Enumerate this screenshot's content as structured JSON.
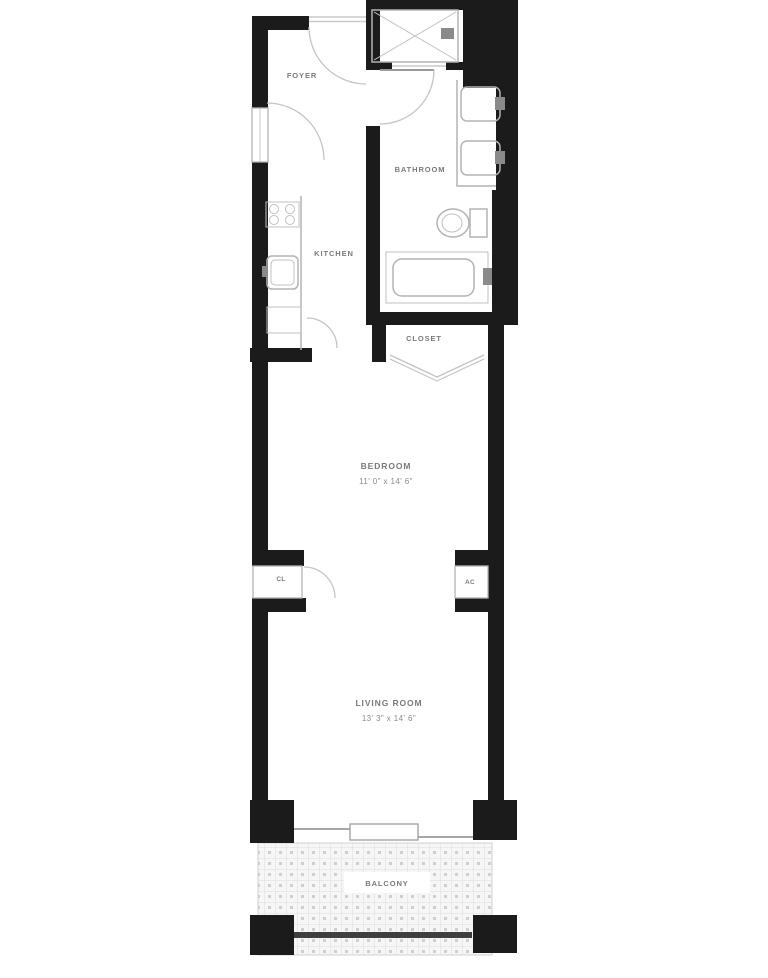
{
  "document": {
    "type": "apartment-floor-plan"
  },
  "colors": {
    "wall": "#1b1b1b",
    "fixture_outline": "#b3b3b3",
    "glass": "#c9c9c9",
    "label_text": "#7a7a7a",
    "railing": "#3f3f3f",
    "balcony_hatch_line": "#dcdcdc",
    "balcony_hatch_dot": "#cfcfcf",
    "background": "#ffffff"
  },
  "rooms": {
    "foyer": {
      "label": "FOYER"
    },
    "bathroom": {
      "label": "BATHROOM"
    },
    "kitchen": {
      "label": "KITCHEN"
    },
    "closet": {
      "label": "CLOSET"
    },
    "bedroom": {
      "label": "BEDROOM",
      "dimensions": "11' 0\" x 14' 6\""
    },
    "closet_cl": {
      "label": "CL"
    },
    "ac_unit": {
      "label": "AC"
    },
    "living_room": {
      "label": "LIVING ROOM",
      "dimensions": "13' 3\" x 14' 6\""
    },
    "balcony": {
      "label": "BALCONY"
    }
  },
  "fixtures": [
    "entry-door",
    "foyer-closet-door",
    "shower-stall",
    "shower-head",
    "bathroom-door",
    "vanity-double-sink",
    "toilet",
    "bathtub",
    "range-stove",
    "kitchen-sink",
    "kitchen-counter",
    "kitchen-cabinet",
    "closet-bifold-doors",
    "cl-closet-door",
    "balcony-sliding-door",
    "balcony-railing"
  ]
}
